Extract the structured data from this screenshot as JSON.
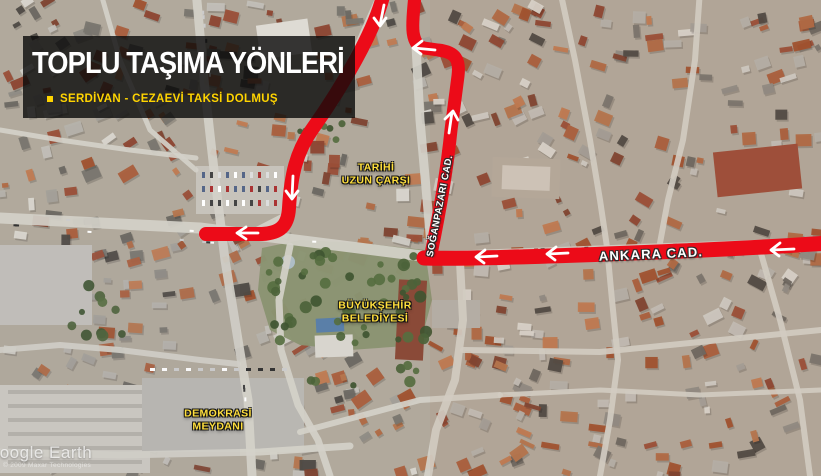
{
  "header": {
    "title": "TOPLU TAŞIMA YÖNLERİ",
    "route_legend": "SERDİVAN - CEZAEVİ TAKSİ DOLMUŞ"
  },
  "map_labels": {
    "historic_bazaar": {
      "lines": [
        "TARİHİ",
        "UZUN ÇARŞI"
      ]
    },
    "soganpazari_street": "SOĞANPAZARI CAD.",
    "ankara_street": "ANKARA CAD.",
    "municipality": {
      "lines": [
        "BÜYÜKŞEHİR",
        "BELEDİYESİ"
      ]
    },
    "democracy_square": {
      "lines": [
        "DEMOKRASİ",
        "MEYDANI"
      ]
    }
  },
  "watermark": {
    "brand": "Google Earth",
    "copyright": "© 2009 Maxar Technologies"
  },
  "colors": {
    "route_red": "#ec0b18",
    "arrow_white": "#ffffff",
    "label_yellow": "#ffdf3d",
    "legend_yellow": "#ffd400",
    "panel_bg": "rgba(10,10,10,0.8)"
  }
}
